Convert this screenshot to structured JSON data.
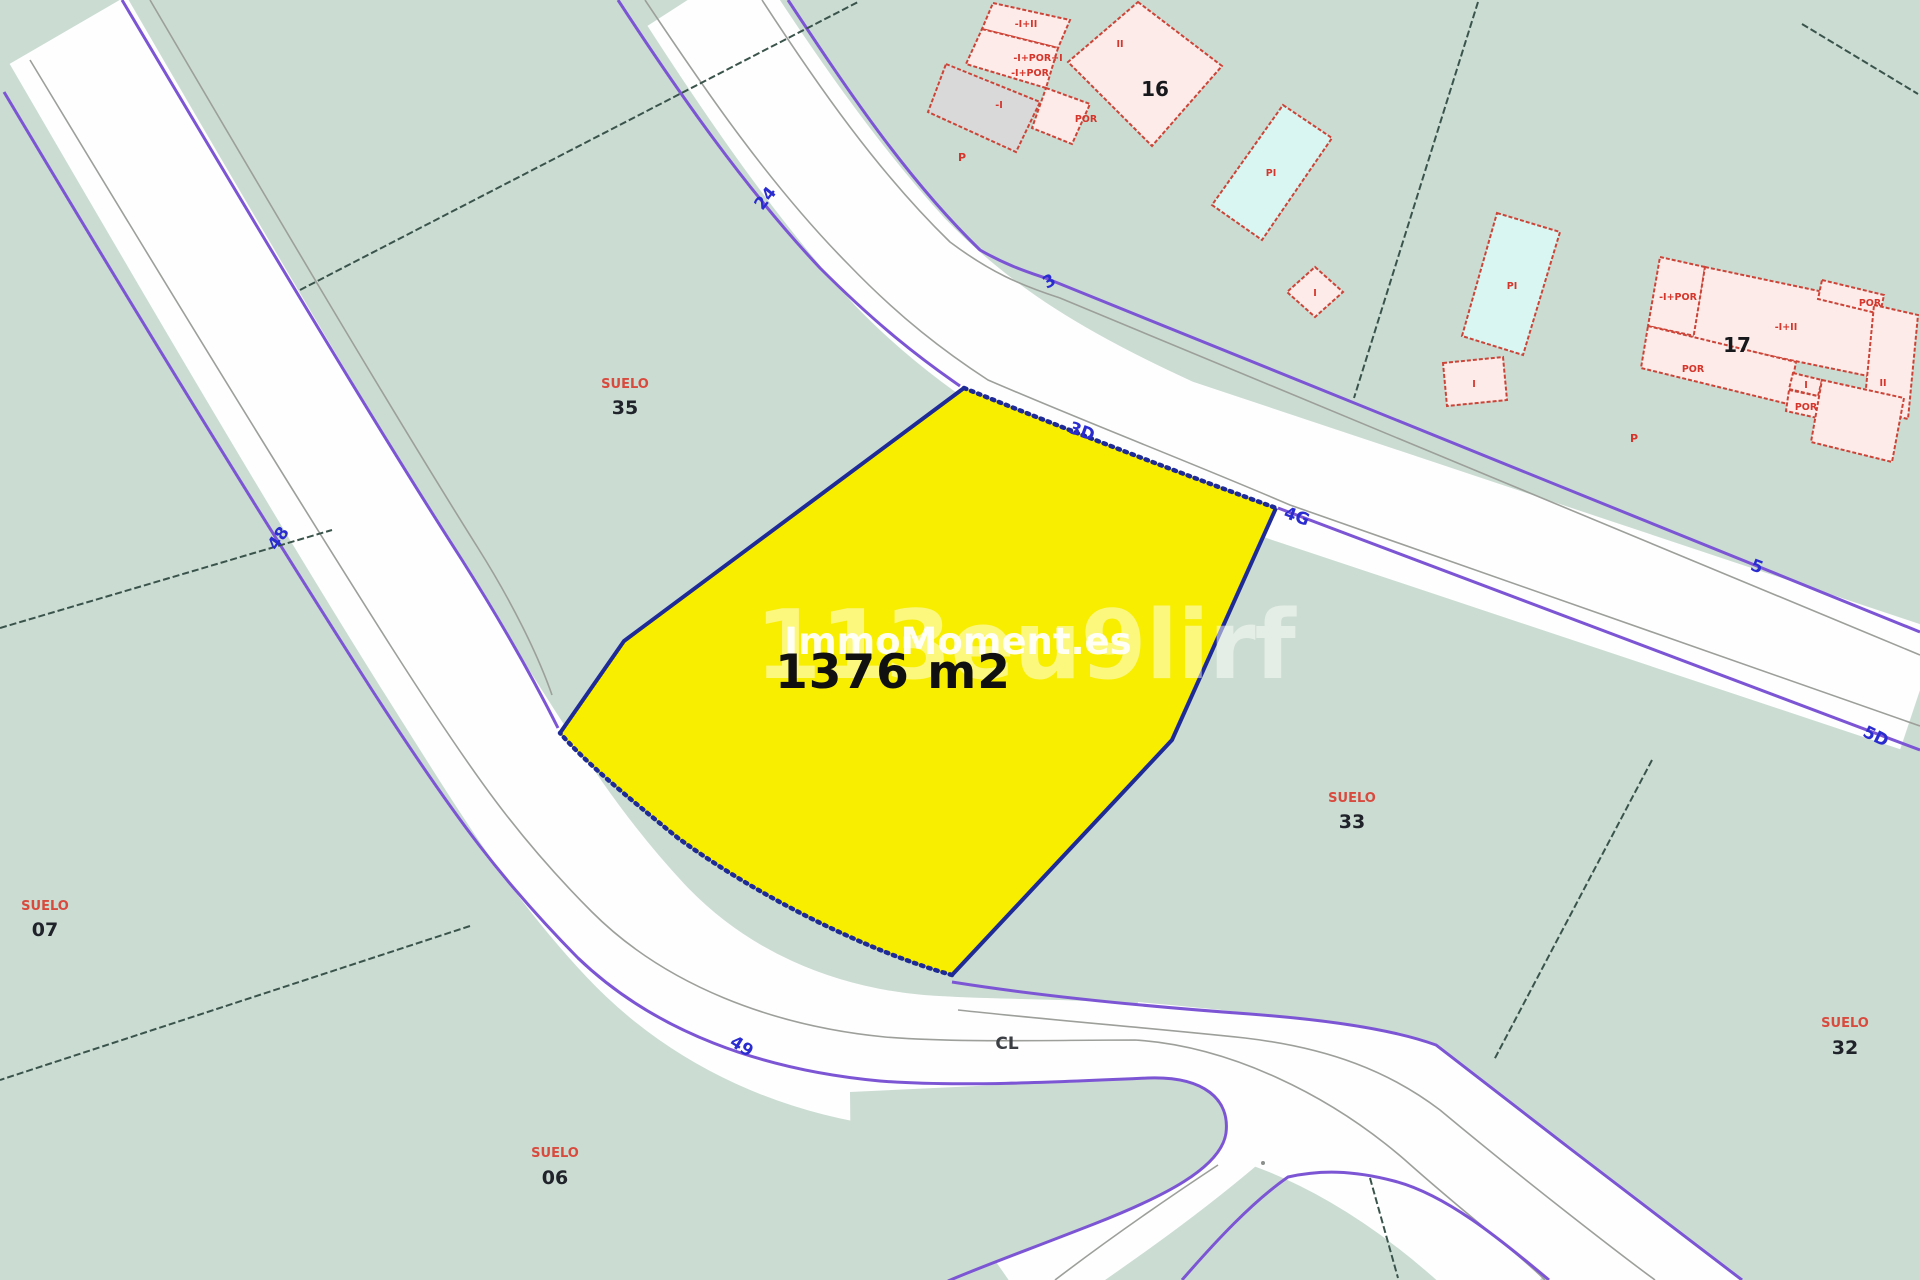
{
  "plot": {
    "area_label": "1376 m2"
  },
  "watermark": {
    "code": "113eu9lirf",
    "brand": "ImmoMoment.es"
  },
  "streets": {
    "s24": "24",
    "s3": "3",
    "s3d": "3D",
    "s4g": "4G",
    "s5": "5",
    "s5d": "5D",
    "s48": "48",
    "s49": "49",
    "cl": "CL"
  },
  "parcels": {
    "suelo": "SUELO",
    "p35": "35",
    "p07": "07",
    "p33": "33",
    "p32": "32",
    "p06": "06"
  },
  "buildings": {
    "b16": "16",
    "b17": "17",
    "ii": "II",
    "i": "I",
    "pi": "PI",
    "por": "POR",
    "p": "P",
    "neg_i": "-I",
    "neg_i_ii": "-I+II",
    "neg_i_por": "-I+POR",
    "neg_i_por_i": "-I+POR+I"
  },
  "colors": {
    "background": "#cbdcd3",
    "road": "#fefefe",
    "road_edge": "#7c55d4",
    "parcel_line": "#3a544c",
    "building_fill": "#fcebe9",
    "building_edge": "#cc4437",
    "pool_fill": "#d9f6f2",
    "annex_fill": "#d9d9d9",
    "plot_fill": "#f8ee00",
    "plot_border": "#1e2a96",
    "street_label": "#2a2ccf",
    "suelo_label": "#d94a3e"
  }
}
